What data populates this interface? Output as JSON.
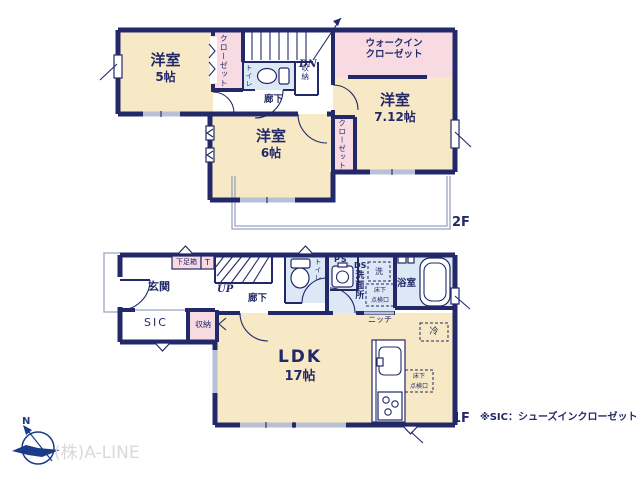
{
  "colors": {
    "wall": "#232968",
    "room": "#f7e9c6",
    "closet": "#f8dbe2",
    "wet": "#dce8f5",
    "window": "#b9c0d6",
    "thin_line": "#9aa3bf",
    "brand_text": "#d9d9d9",
    "compass": "#1a3a8c"
  },
  "floor2": {
    "floor_label": "2F",
    "bedroom5": {
      "name": "洋室",
      "size": "5帖"
    },
    "bedroom6": {
      "name": "洋室",
      "size": "6帖"
    },
    "bedroom712": {
      "name": "洋室",
      "size": "7.12帖"
    },
    "walk_in_closet": "ウォークイン\nクローゼット",
    "closet_left": "クローゼット",
    "closet_right": "クローゼット",
    "toilet": "トイレ",
    "storage": "収納",
    "hallway": "廊下",
    "stairs_down": "DN"
  },
  "floor1": {
    "floor_label": "1F",
    "entrance": "玄関",
    "shoe_box": "下足箱",
    "shoe_box_t": "T",
    "sic": "SIC",
    "storage": "収納",
    "stairs_up": "UP",
    "hallway": "廊下",
    "toilet": "トイレ",
    "pipe_space": "PS",
    "duct_space": "DS",
    "washroom": "洗面所",
    "washer": "洗",
    "floor_hatch": "床下\n点検口",
    "bathroom": "浴室",
    "niche": "ニッチ",
    "refrigerator": "冷",
    "ldk": {
      "name": "LDK",
      "size": "17帖"
    }
  },
  "footer": {
    "note": "※SIC：シューズインクローゼット",
    "company": "(株)A-LINE",
    "compass_north": "N"
  }
}
